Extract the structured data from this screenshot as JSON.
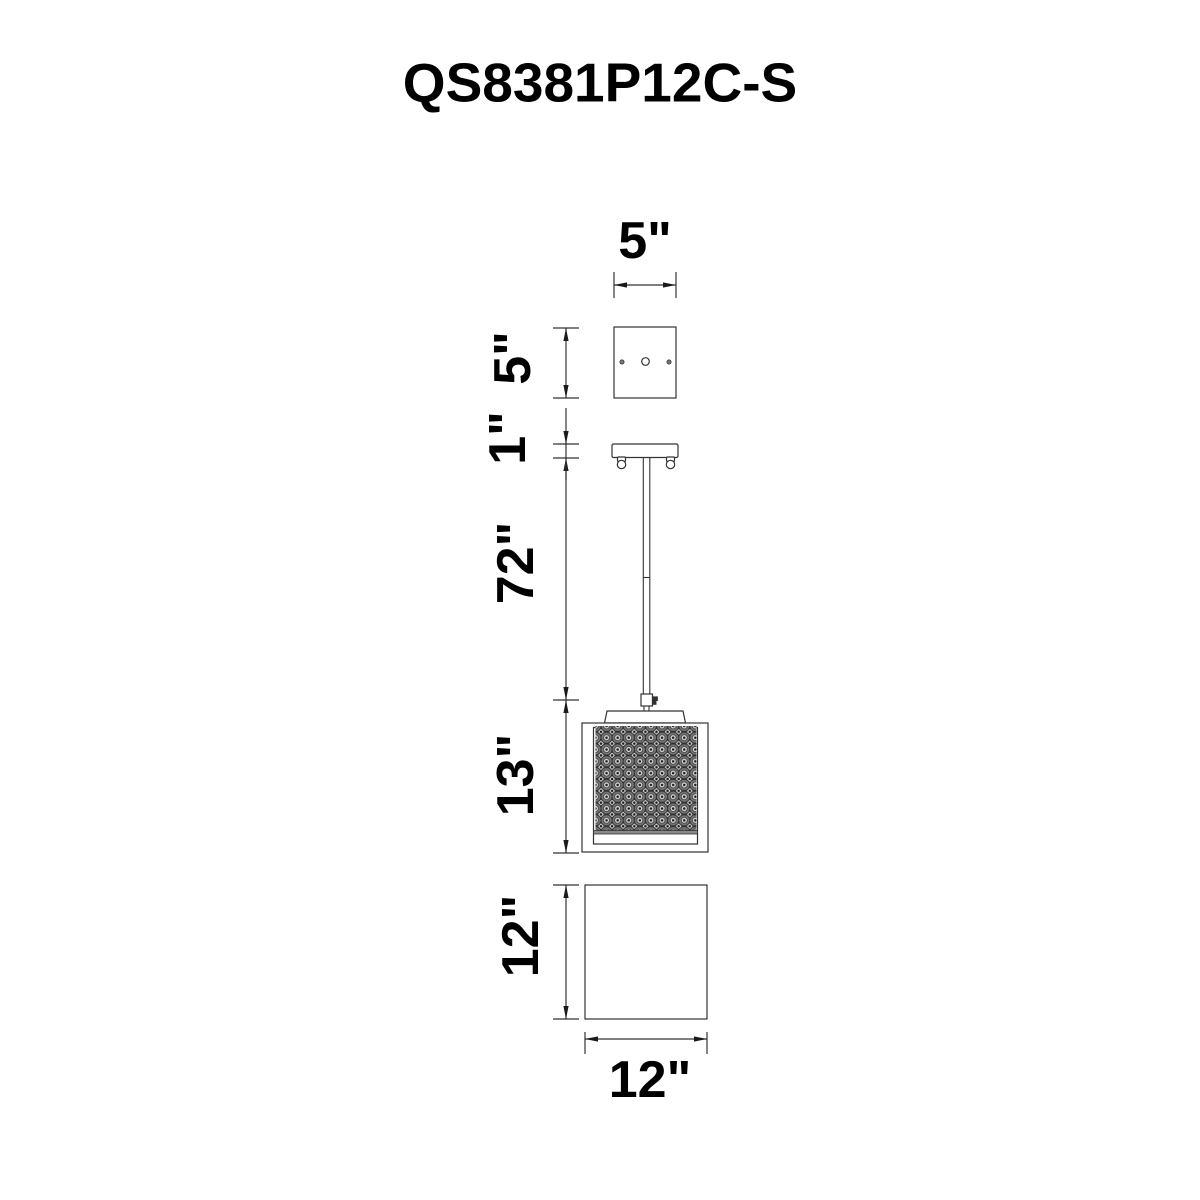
{
  "title": "QS8381P12C-S",
  "dims": {
    "canopy_width": "5\"",
    "canopy_depth": "5\"",
    "canopy_thickness": "1\"",
    "rod_length": "72\"",
    "frame_height": "13\"",
    "shade_height": "12\"",
    "shade_width": "12\""
  },
  "colors": {
    "line": "#333333",
    "arrow": "#1a1a1a",
    "text": "#000000",
    "crystal_outer": "#757575",
    "crystal_inner": "#d6d6d6",
    "crystal_dot": "#1c1c1c",
    "background": "#ffffff"
  }
}
